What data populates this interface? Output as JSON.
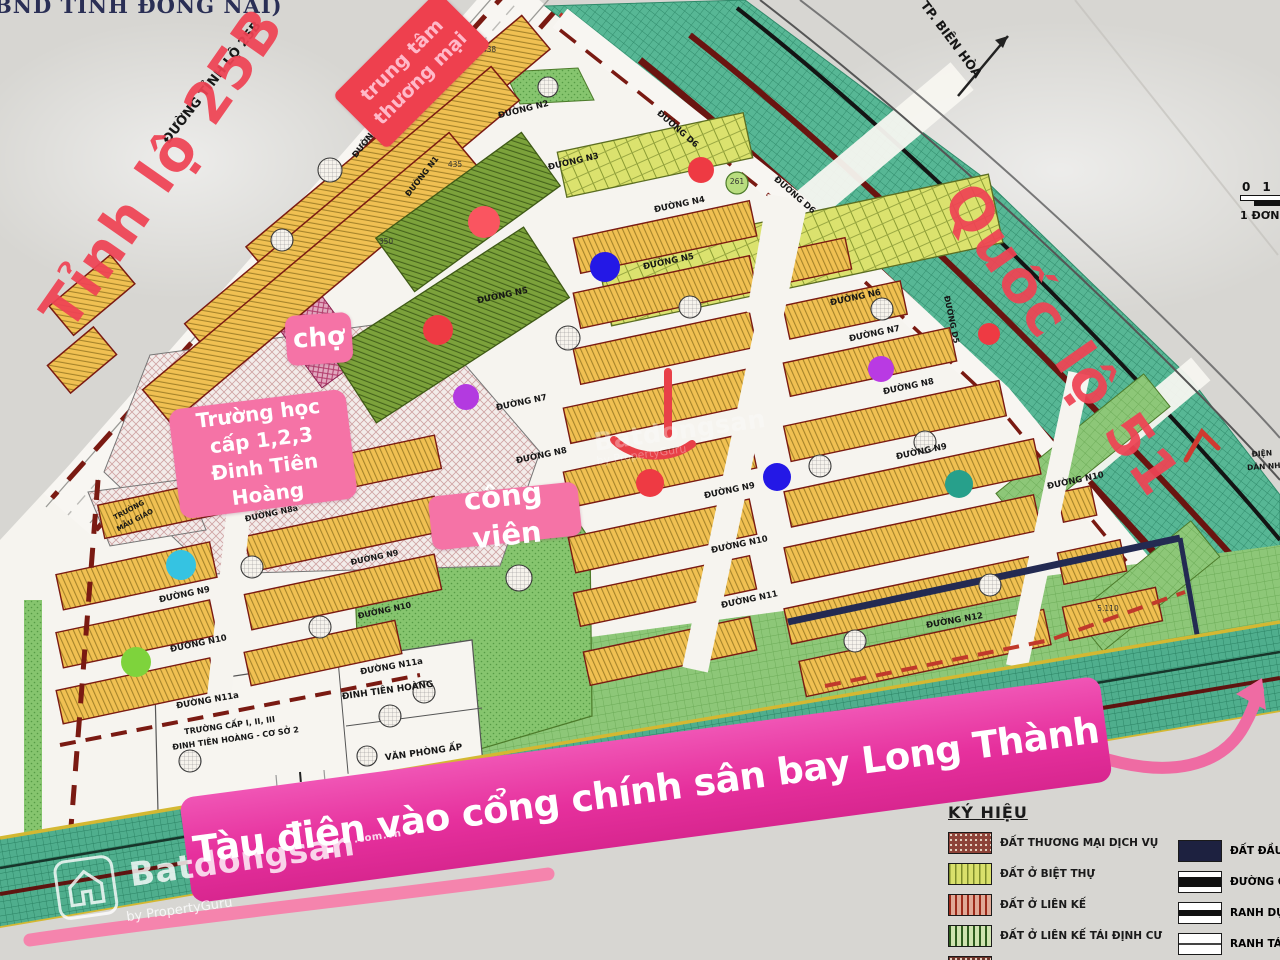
{
  "corner_text": "BND TỈNH ĐỒNG NAI)",
  "scale_bar": {
    "t0": "0",
    "t1": "1",
    "unit": "1 ĐƠN"
  },
  "annotations": {
    "colors": {
      "road_text": "#ef4354",
      "label_pink": "#f573a6",
      "banner_pink": "#e6309d",
      "box_red": "#ee404e"
    },
    "tinh_lo": "Tỉnh lộ 25B",
    "quoc_lo": "Quốc lộ 51",
    "trung_tam": [
      "trung tâm",
      "thương mại"
    ],
    "cho": "chợ",
    "truong_hoc": [
      "Trường học",
      "cấp 1,2,3",
      "Đinh Tiên Hoàng"
    ],
    "cong_vien": "công viên",
    "banner": "Tàu điện vào cổng chính sân bay Long Thành"
  },
  "roads": [
    {
      "t": "ĐƯỜNG TỈNH LỘ 25B",
      "x": 215,
      "y": 85,
      "r": -52,
      "s": 13
    },
    {
      "t": "ĐƯỜNG N1",
      "x": 372,
      "y": 138,
      "r": -52,
      "s": 8.5
    },
    {
      "t": "ĐƯỜNG N1",
      "x": 424,
      "y": 178,
      "r": -52,
      "s": 8
    },
    {
      "t": "ĐƯỜNG N2",
      "x": 524,
      "y": 112,
      "r": -14,
      "s": 8.5
    },
    {
      "t": "ĐƯỜNG N3",
      "x": 574,
      "y": 164,
      "r": -13,
      "s": 8.5
    },
    {
      "t": "ĐƯỜNG D6",
      "x": 676,
      "y": 131,
      "r": 41,
      "s": 8.5
    },
    {
      "t": "ĐƯỜNG D6",
      "x": 793,
      "y": 197,
      "r": 41,
      "s": 8.5
    },
    {
      "t": "ĐƯỜNG N4",
      "x": 680,
      "y": 207,
      "r": -12,
      "s": 8.5
    },
    {
      "t": "ĐƯỜNG N5",
      "x": 669,
      "y": 264,
      "r": -12,
      "s": 8.5
    },
    {
      "t": "ĐƯỜNG N5",
      "x": 503,
      "y": 298,
      "r": -12,
      "s": 8.5
    },
    {
      "t": "ĐƯỜNG N6",
      "x": 856,
      "y": 300,
      "r": -12,
      "s": 8.5
    },
    {
      "t": "ĐƯỜNG N7",
      "x": 875,
      "y": 336,
      "r": -12,
      "s": 8.5
    },
    {
      "t": "ĐƯỜNG N7",
      "x": 522,
      "y": 405,
      "r": -12,
      "s": 8.5
    },
    {
      "t": "ĐƯỜNG N8",
      "x": 909,
      "y": 389,
      "r": -12,
      "s": 8.5
    },
    {
      "t": "ĐƯỜNG N8",
      "x": 542,
      "y": 458,
      "r": -12,
      "s": 8.5
    },
    {
      "t": "ĐƯỜNG N8a",
      "x": 272,
      "y": 516,
      "r": -12,
      "s": 8
    },
    {
      "t": "ĐƯỜNG N9",
      "x": 922,
      "y": 454,
      "r": -12,
      "s": 8.5
    },
    {
      "t": "ĐƯỜNG N9",
      "x": 730,
      "y": 493,
      "r": -12,
      "s": 8.5
    },
    {
      "t": "ĐƯỜNG N9",
      "x": 185,
      "y": 597,
      "r": -12,
      "s": 8.5
    },
    {
      "t": "ĐƯỜNG N9",
      "x": 375,
      "y": 560,
      "r": -12,
      "s": 8
    },
    {
      "t": "ĐƯỜNG N10",
      "x": 1076,
      "y": 483,
      "r": -12,
      "s": 8.5
    },
    {
      "t": "ĐƯỜNG N10",
      "x": 740,
      "y": 547,
      "r": -12,
      "s": 8.5
    },
    {
      "t": "ĐƯỜNG N10",
      "x": 199,
      "y": 646,
      "r": -12,
      "s": 8.5
    },
    {
      "t": "ĐƯỜNG N10",
      "x": 385,
      "y": 613,
      "r": -12,
      "s": 8
    },
    {
      "t": "ĐƯỜNG N11",
      "x": 750,
      "y": 602,
      "r": -12,
      "s": 8.5
    },
    {
      "t": "ĐƯỜNG N11a",
      "x": 208,
      "y": 703,
      "r": -10,
      "s": 8.5
    },
    {
      "t": "ĐƯỜNG N11a",
      "x": 392,
      "y": 669,
      "r": -10,
      "s": 8.5
    },
    {
      "t": "ĐƯỜNG N12",
      "x": 955,
      "y": 623,
      "r": -10,
      "s": 8.5
    },
    {
      "t": "ĐƯỜNG D5",
      "x": 949,
      "y": 320,
      "r": 78,
      "s": 8
    }
  ],
  "places": [
    {
      "t": "TP. BIÊN HÒA",
      "x": 948,
      "y": 42,
      "r": 53,
      "s": 12.5
    },
    {
      "t": "TRƯỜNG",
      "x": 130,
      "y": 512,
      "r": -28,
      "s": 7
    },
    {
      "t": "MẪU GIÁO",
      "x": 136,
      "y": 522,
      "r": -28,
      "s": 7
    },
    {
      "t": "ĐINH TIÊN HOÀNG",
      "x": 388,
      "y": 693,
      "r": -8,
      "s": 9
    },
    {
      "t": "VĂN PHÒNG ẤP",
      "x": 424,
      "y": 755,
      "r": -8,
      "s": 9
    },
    {
      "t": "TRƯỜNG CẤP I, II, III",
      "x": 230,
      "y": 728,
      "r": -8,
      "s": 8
    },
    {
      "t": "ĐINH TIÊN HOÀNG - CƠ SỞ 2",
      "x": 236,
      "y": 741,
      "r": -8,
      "s": 8
    },
    {
      "t": "ĐIỆN",
      "x": 1262,
      "y": 456,
      "r": -4,
      "s": 7.5
    },
    {
      "t": "DÂN NH",
      "x": 1264,
      "y": 469,
      "r": -4,
      "s": 7.5
    }
  ],
  "plot_numbers": [
    {
      "t": "438",
      "x": 489,
      "y": 52
    },
    {
      "t": "435",
      "x": 455,
      "y": 167
    },
    {
      "t": "350",
      "x": 386,
      "y": 244
    },
    {
      "t": "261",
      "x": 737,
      "y": 184
    },
    {
      "t": "5.110",
      "x": 1108,
      "y": 611
    }
  ],
  "dots": [
    {
      "x": 484,
      "y": 222,
      "r": 16,
      "c": "#fa5560"
    },
    {
      "x": 438,
      "y": 330,
      "r": 15,
      "c": "#ee3a43"
    },
    {
      "x": 605,
      "y": 267,
      "r": 15,
      "c": "#2418e6"
    },
    {
      "x": 466,
      "y": 397,
      "r": 13,
      "c": "#b33ae0"
    },
    {
      "x": 701,
      "y": 170,
      "r": 13,
      "c": "#ee3a43"
    },
    {
      "x": 989,
      "y": 334,
      "r": 11,
      "c": "#ee3a43"
    },
    {
      "x": 881,
      "y": 369,
      "r": 13,
      "c": "#b93ae3"
    },
    {
      "x": 650,
      "y": 483,
      "r": 14,
      "c": "#ee3a43"
    },
    {
      "x": 777,
      "y": 477,
      "r": 14,
      "c": "#2418e6"
    },
    {
      "x": 959,
      "y": 484,
      "r": 14,
      "c": "#27a08b"
    },
    {
      "x": 181,
      "y": 565,
      "r": 15,
      "c": "#35c3e2"
    },
    {
      "x": 136,
      "y": 662,
      "r": 15,
      "c": "#7ed33c"
    }
  ],
  "legend": {
    "title": "KÝ HIỆU",
    "left": [
      {
        "label": "ĐẤT THƯƠNG MẠI DỊCH VỤ",
        "swatch": "commercial"
      },
      {
        "label": "ĐẤT Ở BIỆT THỰ",
        "swatch": "villa"
      },
      {
        "label": "ĐẤT Ở LIÊN KẾ",
        "swatch": "rowhouse"
      },
      {
        "label": "ĐẤT Ở LIÊN KẾ TÁI ĐỊNH CƯ",
        "swatch": "resettle"
      },
      {
        "label": "",
        "swatch": "commercial2"
      }
    ],
    "right": [
      {
        "label": "ĐẤT ĐẦU M",
        "swatch": "navy"
      },
      {
        "label": "ĐƯỜNG QU",
        "swatch": "road"
      },
      {
        "label": "RANH DỰ Á",
        "swatch": "ranh1"
      },
      {
        "label": "RANH TÁI ĐỊ",
        "swatch": "ranh2"
      }
    ]
  },
  "watermark": {
    "brand": "Batdongsan",
    "suffix": ".com.vn",
    "byline": "by PropertyGuru"
  }
}
